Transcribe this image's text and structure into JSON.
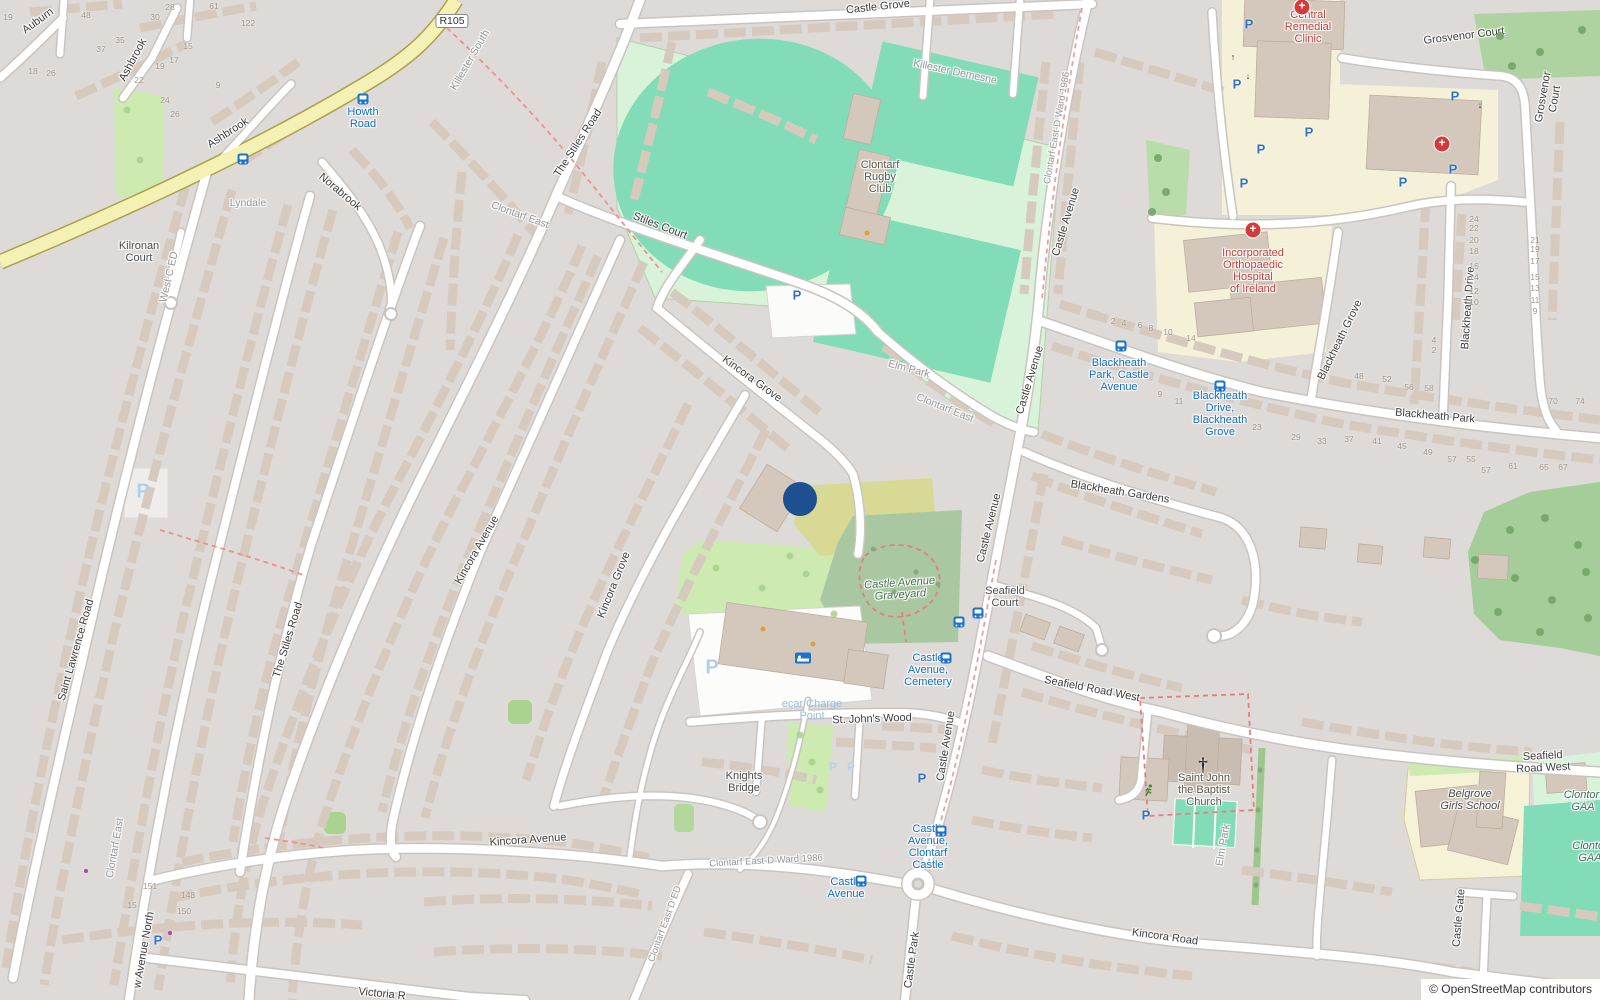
{
  "map": {
    "attribution": "© OpenStreetMap contributors",
    "marker": {
      "x": 800,
      "y": 499,
      "r": 17,
      "color": "#1d4f91"
    },
    "colors": {
      "pitch": "#82dcb8",
      "pitch_surround": "#d9f3da",
      "grass": "#cdebb0",
      "cemetery": "#a9c8a1",
      "scrub": "#d8d995",
      "wood": "#a5cd99",
      "institution_yellow": "#f5f1d9",
      "road_yellow": "#f4f1b4",
      "bus_blue": "#1a74c9",
      "hospital_red": "#d23b3b",
      "building": "#d6cabf"
    }
  },
  "labels": [
    {
      "n": "road-label-auburn",
      "t": "Auburn",
      "x": 38,
      "y": 21,
      "r": -36,
      "c": "road"
    },
    {
      "n": "road-label-ashbrook-1",
      "t": "Ashbrook",
      "x": 133,
      "y": 60,
      "r": -62,
      "c": "road"
    },
    {
      "n": "road-label-ashbrook-2",
      "t": "Ashbrook",
      "x": 228,
      "y": 133,
      "r": -33,
      "c": "road"
    },
    {
      "n": "road-label-norabrook",
      "t": "Norabrook",
      "x": 340,
      "y": 192,
      "r": 40,
      "c": "road"
    },
    {
      "n": "place-label-lyndale",
      "t": "Lyndale",
      "x": 248,
      "y": 203,
      "r": 0,
      "c": "place"
    },
    {
      "n": "place-label-kilronan-court",
      "t": "Kilronan\nCourt",
      "x": 139,
      "y": 252,
      "r": 0,
      "c": "dark"
    },
    {
      "n": "place-label-west-c-ed",
      "t": "West C ED",
      "x": 169,
      "y": 277,
      "r": -77,
      "c": "place"
    },
    {
      "n": "route-badge-r105",
      "t": "R105",
      "x": 452,
      "y": 21,
      "r": 0,
      "c": "badge"
    },
    {
      "n": "place-label-killester-south",
      "t": "Killester South",
      "x": 470,
      "y": 60,
      "r": -60,
      "c": "place"
    },
    {
      "n": "road-label-the-stiles-road-upper",
      "t": "The Stiles Road",
      "x": 578,
      "y": 143,
      "r": -57,
      "c": "road"
    },
    {
      "n": "road-label-stiles-court",
      "t": "Stiles Court",
      "x": 660,
      "y": 226,
      "r": 21,
      "c": "road"
    },
    {
      "n": "place-label-clontarf-east-upper",
      "t": "Clontarf East",
      "x": 520,
      "y": 215,
      "r": 20,
      "c": "place"
    },
    {
      "n": "road-label-castle-grove",
      "t": "Castle Grove",
      "x": 878,
      "y": 7,
      "r": -6,
      "c": "road"
    },
    {
      "n": "place-label-killester-demesne",
      "t": "Killester Demesne",
      "x": 955,
      "y": 72,
      "r": 12,
      "c": "place"
    },
    {
      "n": "poi-label-clontarf-rugby-club",
      "t": "Clontarf\nRugby\nClub",
      "x": 880,
      "y": 177,
      "r": 0,
      "c": "poi"
    },
    {
      "n": "place-label-elm-park-pitch",
      "t": "Elm Park",
      "x": 909,
      "y": 369,
      "r": 15,
      "c": "place"
    },
    {
      "n": "place-label-clontarf-east-mid",
      "t": "Clontarf East",
      "x": 945,
      "y": 408,
      "r": 22,
      "c": "place"
    },
    {
      "n": "road-label-castle-avenue-top",
      "t": "Castle Avenue",
      "x": 1066,
      "y": 222,
      "r": -73,
      "c": "road"
    },
    {
      "n": "boundary-label-ward-top",
      "t": "Clontarf East-D Ward 1986",
      "x": 1057,
      "y": 128,
      "r": -80,
      "c": "place",
      "s": 9.5
    },
    {
      "n": "road-label-castle-avenue-2",
      "t": "Castle Avenue",
      "x": 1030,
      "y": 380,
      "r": -73,
      "c": "road"
    },
    {
      "n": "road-label-castle-avenue-3",
      "t": "Castle Avenue",
      "x": 989,
      "y": 528,
      "r": -76,
      "c": "road"
    },
    {
      "n": "road-label-castle-avenue-4",
      "t": "Castle Avenue",
      "x": 946,
      "y": 746,
      "r": -81,
      "c": "road"
    },
    {
      "n": "road-label-grosvenor-court-top",
      "t": "Grosvenor Court",
      "x": 1464,
      "y": 36,
      "r": -7,
      "c": "road"
    },
    {
      "n": "road-label-grosvenor-court-side",
      "t": "Grosvenor Court",
      "x": 1549,
      "y": 98,
      "r": -80,
      "c": "road"
    },
    {
      "n": "poi-label-central-remedial-clinic",
      "t": "Central\nRemedial\nClinic",
      "x": 1308,
      "y": 27,
      "r": 0,
      "c": "med"
    },
    {
      "n": "poi-label-orthopaedic-hospital",
      "t": "Incorporated\nOrthopaedic\nHospital\nof Ireland",
      "x": 1253,
      "y": 271,
      "r": 0,
      "c": "med"
    },
    {
      "n": "road-label-blackheath-grove",
      "t": "Blackheath Grove",
      "x": 1340,
      "y": 340,
      "r": -64,
      "c": "road"
    },
    {
      "n": "road-label-blackheath-drive",
      "t": "Blackheath Drive",
      "x": 1468,
      "y": 308,
      "r": -86,
      "c": "road"
    },
    {
      "n": "road-label-blackheath-park",
      "t": "Blackheath Park",
      "x": 1435,
      "y": 416,
      "r": 5,
      "c": "road"
    },
    {
      "n": "bus-stop-label-blackheath-park",
      "t": "Blackheath\nPark, Castle\nAvenue",
      "x": 1119,
      "y": 375,
      "r": 0,
      "c": "bus"
    },
    {
      "n": "bus-stop-label-blackheath-drive",
      "t": "Blackheath\nDrive,\nBlackheath\nGrove",
      "x": 1220,
      "y": 414,
      "r": 0,
      "c": "bus"
    },
    {
      "n": "road-label-blackheath-gardens",
      "t": "Blackheath Gardens",
      "x": 1120,
      "y": 492,
      "r": 9,
      "c": "road"
    },
    {
      "n": "road-label-kincora-grove-upper",
      "t": "Kincora Grove",
      "x": 752,
      "y": 379,
      "r": 36,
      "c": "road"
    },
    {
      "n": "road-label-kincora-grove-lower",
      "t": "Kincora Grove",
      "x": 614,
      "y": 585,
      "r": -68,
      "c": "road"
    },
    {
      "n": "road-label-kincora-avenue-diag",
      "t": "Kincora Avenue",
      "x": 477,
      "y": 550,
      "r": -60,
      "c": "road"
    },
    {
      "n": "road-label-the-stiles-road-lower",
      "t": "The Stiles Road",
      "x": 288,
      "y": 640,
      "r": -73,
      "c": "road"
    },
    {
      "n": "road-label-saint-lawrence-road",
      "t": "Saint Lawrence Road",
      "x": 76,
      "y": 650,
      "r": -74,
      "c": "road"
    },
    {
      "n": "poi-label-castle-avenue-graveyard",
      "t": "Castle Avenue\nGraveyard",
      "x": 900,
      "y": 589,
      "r": -4,
      "c": "grave"
    },
    {
      "n": "place-label-seafield-court",
      "t": "Seafield\nCourt",
      "x": 1005,
      "y": 597,
      "r": 0,
      "c": "dark"
    },
    {
      "n": "bus-stop-label-castle-avenue-cemetery",
      "t": "Castle\nAvenue,\nCemetery",
      "x": 928,
      "y": 670,
      "r": 0,
      "c": "bus"
    },
    {
      "n": "road-label-seafield-road-west-1",
      "t": "Seafield Road West",
      "x": 1092,
      "y": 689,
      "r": 11,
      "c": "road"
    },
    {
      "n": "road-label-seafield-road-west-2",
      "t": "Seafield Road West",
      "x": 1543,
      "y": 762,
      "r": -3,
      "c": "road"
    },
    {
      "n": "poi-label-saint-john-the-baptist-church",
      "t": "Saint John\nthe Baptist\nChurch",
      "x": 1204,
      "y": 790,
      "r": 0,
      "c": "poi"
    },
    {
      "n": "road-label-elm-park",
      "t": "Elm Park",
      "x": 1223,
      "y": 845,
      "r": -80,
      "c": "place"
    },
    {
      "n": "road-label-st-johns-wood",
      "t": "St. John's Wood",
      "x": 872,
      "y": 719,
      "r": -2,
      "c": "road"
    },
    {
      "n": "place-label-knights-bridge",
      "t": "Knights\nBridge",
      "x": 744,
      "y": 782,
      "r": 0,
      "c": "dark"
    },
    {
      "n": "boundary-label-ward-bottom",
      "t": "Clontarf East-D Ward 1986",
      "x": 766,
      "y": 861,
      "r": -3,
      "c": "place",
      "s": 9.5
    },
    {
      "n": "bus-stop-label-castle-avenue",
      "t": "Castle\nAvenue",
      "x": 846,
      "y": 888,
      "r": 0,
      "c": "bus"
    },
    {
      "n": "bus-stop-label-castle-avenue-clontarf-castle",
      "t": "Castle\nAvenue,\nClontarf\nCastle",
      "x": 928,
      "y": 847,
      "r": 0,
      "c": "bus"
    },
    {
      "n": "road-label-castle-park",
      "t": "Castle Park",
      "x": 912,
      "y": 960,
      "r": -82,
      "c": "road"
    },
    {
      "n": "road-label-kincora-road",
      "t": "Kincora Road",
      "x": 1165,
      "y": 937,
      "r": 8,
      "c": "road"
    },
    {
      "n": "road-label-castle-gate",
      "t": "Castle Gate",
      "x": 1459,
      "y": 918,
      "r": -85,
      "c": "road"
    },
    {
      "n": "poi-label-belgrove-girls-school",
      "t": "Belgrove\nGirls School",
      "x": 1470,
      "y": 800,
      "r": 0,
      "c": "school"
    },
    {
      "n": "poi-label-clontarf-gaa-1",
      "t": "Clontorf\nGAA",
      "x": 1583,
      "y": 801,
      "r": 0,
      "c": "gaa"
    },
    {
      "n": "poi-label-clontarf-gaa-2",
      "t": "Clontor\nGAA",
      "x": 1590,
      "y": 852,
      "r": 0,
      "c": "gaa"
    },
    {
      "n": "road-label-kincora-avenue",
      "t": "Kincora Avenue",
      "x": 528,
      "y": 840,
      "r": -4,
      "c": "road"
    },
    {
      "n": "boundary-label-clontarf-east-d-ed",
      "t": "Clontarf East D ED",
      "x": 665,
      "y": 924,
      "r": -70,
      "c": "place",
      "s": 9.5
    },
    {
      "n": "place-label-clontarf-east-bottom",
      "t": "Clontarf East",
      "x": 115,
      "y": 848,
      "r": -80,
      "c": "place"
    },
    {
      "n": "road-label-avenue-north",
      "t": "w Avenue North",
      "x": 144,
      "y": 950,
      "r": -80,
      "c": "road"
    },
    {
      "n": "road-label-victoria",
      "t": "Victoria R",
      "x": 382,
      "y": 994,
      "r": 6,
      "c": "road"
    },
    {
      "n": "poi-label-ecar-charge-point",
      "t": "ecar Charge\nPoint",
      "x": 812,
      "y": 710,
      "r": 0,
      "c": "pale"
    },
    {
      "n": "bus-stop-label-howth-road",
      "t": "Howth\nRoad",
      "x": 363,
      "y": 118,
      "r": 0,
      "c": "bus"
    }
  ],
  "housenumbers": [
    {
      "t": "19",
      "x": 8,
      "y": 17
    },
    {
      "t": "48",
      "x": 86,
      "y": 15
    },
    {
      "t": "28",
      "x": 170,
      "y": 7
    },
    {
      "t": "30",
      "x": 155,
      "y": 17
    },
    {
      "t": "61",
      "x": 214,
      "y": 6
    },
    {
      "t": "122",
      "x": 248,
      "y": 23
    },
    {
      "t": "37",
      "x": 101,
      "y": 49
    },
    {
      "t": "35",
      "x": 120,
      "y": 40
    },
    {
      "t": "22",
      "x": 139,
      "y": 80
    },
    {
      "t": "19",
      "x": 160,
      "y": 66
    },
    {
      "t": "17",
      "x": 174,
      "y": 60
    },
    {
      "t": "15",
      "x": 188,
      "y": 46
    },
    {
      "t": "9",
      "x": 218,
      "y": 85
    },
    {
      "t": "24",
      "x": 165,
      "y": 100
    },
    {
      "t": "26",
      "x": 175,
      "y": 114
    },
    {
      "t": "18",
      "x": 33,
      "y": 71
    },
    {
      "t": "26",
      "x": 51,
      "y": 73
    },
    {
      "t": "151",
      "x": 150,
      "y": 886
    },
    {
      "t": "15",
      "x": 132,
      "y": 905
    },
    {
      "t": "148",
      "x": 188,
      "y": 895
    },
    {
      "t": "150",
      "x": 184,
      "y": 911
    },
    {
      "t": "2",
      "x": 1113,
      "y": 321
    },
    {
      "t": "4",
      "x": 1124,
      "y": 323
    },
    {
      "t": "6",
      "x": 1140,
      "y": 325
    },
    {
      "t": "8",
      "x": 1151,
      "y": 328
    },
    {
      "t": "10",
      "x": 1168,
      "y": 332
    },
    {
      "t": "14",
      "x": 1191,
      "y": 338
    },
    {
      "t": "9",
      "x": 1160,
      "y": 394
    },
    {
      "t": "11",
      "x": 1179,
      "y": 401
    },
    {
      "t": "23",
      "x": 1257,
      "y": 427
    },
    {
      "t": "29",
      "x": 1296,
      "y": 437
    },
    {
      "t": "33",
      "x": 1322,
      "y": 441
    },
    {
      "t": "37",
      "x": 1349,
      "y": 439
    },
    {
      "t": "41",
      "x": 1377,
      "y": 441
    },
    {
      "t": "45",
      "x": 1402,
      "y": 446
    },
    {
      "t": "49",
      "x": 1428,
      "y": 452
    },
    {
      "t": "57",
      "x": 1452,
      "y": 459
    },
    {
      "t": "48",
      "x": 1359,
      "y": 376
    },
    {
      "t": "52",
      "x": 1387,
      "y": 379
    },
    {
      "t": "56",
      "x": 1409,
      "y": 387
    },
    {
      "t": "58",
      "x": 1429,
      "y": 388
    },
    {
      "t": "55",
      "x": 1471,
      "y": 459
    },
    {
      "t": "57",
      "x": 1486,
      "y": 470
    },
    {
      "t": "61",
      "x": 1513,
      "y": 466
    },
    {
      "t": "65",
      "x": 1544,
      "y": 467
    },
    {
      "t": "67",
      "x": 1563,
      "y": 467
    },
    {
      "t": "70",
      "x": 1553,
      "y": 401
    },
    {
      "t": "74",
      "x": 1580,
      "y": 401
    },
    {
      "t": "24",
      "x": 1474,
      "y": 219
    },
    {
      "t": "22",
      "x": 1474,
      "y": 228
    },
    {
      "t": "20",
      "x": 1474,
      "y": 240
    },
    {
      "t": "18",
      "x": 1474,
      "y": 251
    },
    {
      "t": "16",
      "x": 1474,
      "y": 266
    },
    {
      "t": "14",
      "x": 1474,
      "y": 277
    },
    {
      "t": "12",
      "x": 1474,
      "y": 291
    },
    {
      "t": "10",
      "x": 1474,
      "y": 302
    },
    {
      "t": "21",
      "x": 1535,
      "y": 240
    },
    {
      "t": "19",
      "x": 1535,
      "y": 249
    },
    {
      "t": "17",
      "x": 1535,
      "y": 261
    },
    {
      "t": "15",
      "x": 1535,
      "y": 277
    },
    {
      "t": "13",
      "x": 1535,
      "y": 288
    },
    {
      "t": "11",
      "x": 1535,
      "y": 300
    },
    {
      "t": "9",
      "x": 1535,
      "y": 311
    },
    {
      "t": "4",
      "x": 1434,
      "y": 340
    },
    {
      "t": "2",
      "x": 1434,
      "y": 350
    }
  ],
  "icons": [
    {
      "t": "parking",
      "x": 797,
      "y": 295
    },
    {
      "t": "parking",
      "x": 1249,
      "y": 24
    },
    {
      "t": "parking",
      "x": 1237,
      "y": 84
    },
    {
      "t": "parking",
      "x": 1309,
      "y": 132
    },
    {
      "t": "parking",
      "x": 1261,
      "y": 149
    },
    {
      "t": "parking",
      "x": 1244,
      "y": 183
    },
    {
      "t": "parking",
      "x": 1455,
      "y": 96
    },
    {
      "t": "parking",
      "x": 1453,
      "y": 169
    },
    {
      "t": "parking",
      "x": 1403,
      "y": 182
    },
    {
      "t": "parking",
      "x": 1146,
      "y": 815
    },
    {
      "t": "parking",
      "x": 922,
      "y": 778
    },
    {
      "t": "parking",
      "x": 158,
      "y": 940
    },
    {
      "t": "parking-faint",
      "x": 712,
      "y": 668
    },
    {
      "t": "parking-faint",
      "x": 143,
      "y": 492
    },
    {
      "t": "parking-faint-sm",
      "x": 833,
      "y": 767
    },
    {
      "t": "parking-faint-sm",
      "x": 851,
      "y": 767
    },
    {
      "t": "bus",
      "x": 363,
      "y": 99
    },
    {
      "t": "bus",
      "x": 243,
      "y": 159
    },
    {
      "t": "bus",
      "x": 1121,
      "y": 346
    },
    {
      "t": "bus",
      "x": 1220,
      "y": 386
    },
    {
      "t": "bus",
      "x": 959,
      "y": 622
    },
    {
      "t": "bus",
      "x": 978,
      "y": 613
    },
    {
      "t": "bus",
      "x": 946,
      "y": 658
    },
    {
      "t": "bus",
      "x": 861,
      "y": 881
    },
    {
      "t": "bus",
      "x": 941,
      "y": 831
    },
    {
      "t": "hospital",
      "x": 1302,
      "y": 7
    },
    {
      "t": "hospital",
      "x": 1442,
      "y": 144
    },
    {
      "t": "hospital",
      "x": 1253,
      "y": 230
    },
    {
      "t": "church",
      "x": 1203,
      "y": 766
    },
    {
      "t": "runner",
      "x": 1149,
      "y": 793
    },
    {
      "t": "bed",
      "x": 803,
      "y": 658
    },
    {
      "t": "dot-orange",
      "x": 763,
      "y": 629
    },
    {
      "t": "dot-orange",
      "x": 813,
      "y": 644
    },
    {
      "t": "dot-orange",
      "x": 867,
      "y": 233
    },
    {
      "t": "dot-purple",
      "x": 86,
      "y": 871
    },
    {
      "t": "dot-purple",
      "x": 170,
      "y": 933
    },
    {
      "t": "arrow-up",
      "x": 1233,
      "y": 57
    },
    {
      "t": "arrow-down",
      "x": 1248,
      "y": 76
    },
    {
      "t": "arrow-down",
      "x": 1480,
      "y": 105
    }
  ],
  "trees": [
    {
      "t": "tree",
      "x": 1510,
      "y": 530
    },
    {
      "t": "tree",
      "x": 1545,
      "y": 518
    },
    {
      "t": "tree",
      "x": 1578,
      "y": 545
    },
    {
      "t": "tree",
      "x": 1515,
      "y": 578
    },
    {
      "t": "tree",
      "x": 1552,
      "y": 600
    },
    {
      "t": "tree",
      "x": 1586,
      "y": 572
    },
    {
      "t": "tree",
      "x": 1498,
      "y": 612
    },
    {
      "t": "tree",
      "x": 1540,
      "y": 632
    },
    {
      "t": "tree",
      "x": 1588,
      "y": 618
    },
    {
      "t": "tree",
      "x": 1475,
      "y": 560
    },
    {
      "t": "tree",
      "x": 1500,
      "y": 36
    },
    {
      "t": "tree",
      "x": 1540,
      "y": 52
    },
    {
      "t": "tree",
      "x": 1582,
      "y": 30
    },
    {
      "t": "tree",
      "x": 1512,
      "y": 66
    },
    {
      "t": "tree",
      "x": 1158,
      "y": 158
    },
    {
      "t": "tree",
      "x": 1166,
      "y": 192
    },
    {
      "t": "tree",
      "x": 1152,
      "y": 212
    },
    {
      "t": "treesm",
      "x": 873,
      "y": 549
    },
    {
      "t": "treesm",
      "x": 916,
      "y": 572
    },
    {
      "t": "treesm",
      "x": 894,
      "y": 592
    },
    {
      "t": "treesm",
      "x": 938,
      "y": 584
    },
    {
      "t": "bush",
      "x": 716,
      "y": 568
    },
    {
      "t": "bush",
      "x": 762,
      "y": 588
    },
    {
      "t": "bush",
      "x": 806,
      "y": 574
    },
    {
      "t": "bush",
      "x": 834,
      "y": 614
    },
    {
      "t": "bush",
      "x": 790,
      "y": 556
    },
    {
      "t": "bush",
      "x": 800,
      "y": 735
    },
    {
      "t": "bush",
      "x": 812,
      "y": 762
    },
    {
      "t": "bush",
      "x": 820,
      "y": 790
    },
    {
      "t": "treesm",
      "x": 1260,
      "y": 770
    },
    {
      "t": "treesm",
      "x": 1258,
      "y": 810
    },
    {
      "t": "treesm",
      "x": 1257,
      "y": 850
    },
    {
      "t": "treesm",
      "x": 1256,
      "y": 885
    },
    {
      "t": "bush",
      "x": 127,
      "y": 110
    },
    {
      "t": "bush",
      "x": 140,
      "y": 160
    }
  ]
}
